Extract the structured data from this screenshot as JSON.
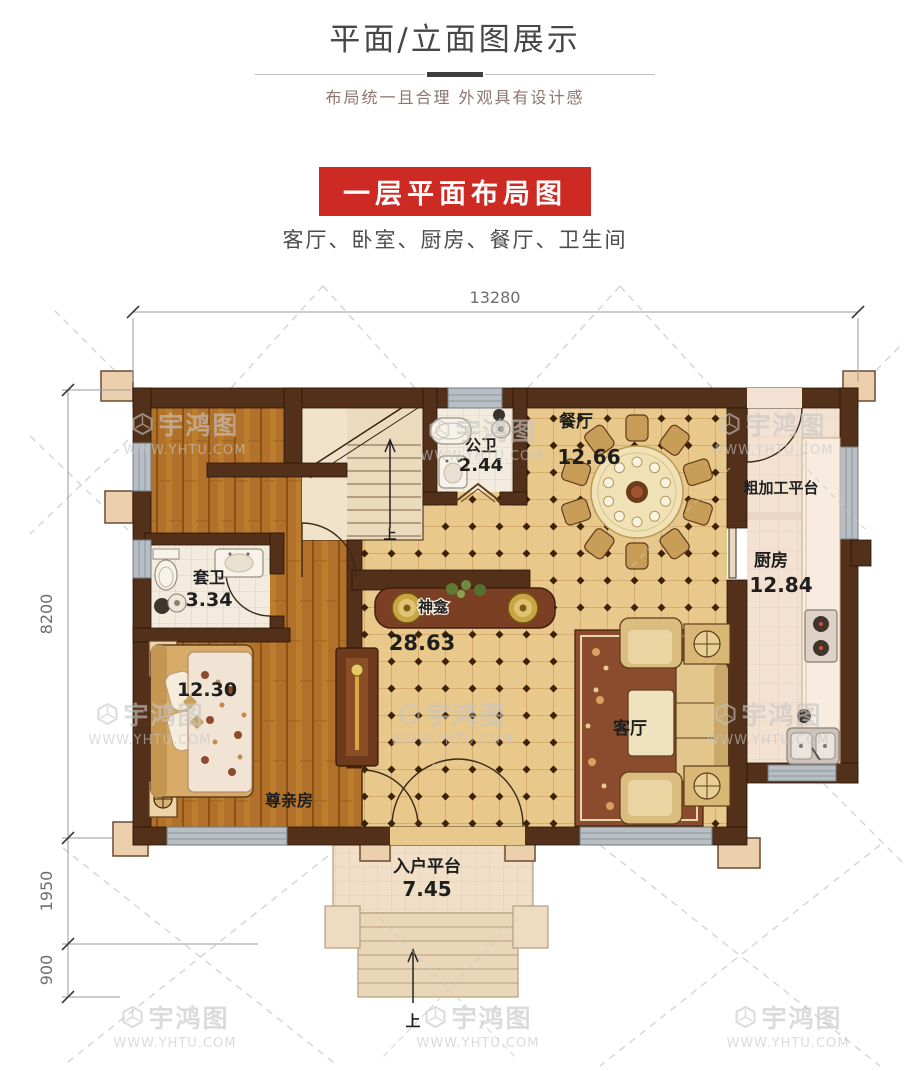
{
  "header": {
    "title": "平面/立面图展示",
    "subtitle": "布局统一且合理  外观具有设计感",
    "banner": "一层平面布局图",
    "rooms_line": "客厅、卧室、厨房、餐厅、卫生间",
    "banner_color": "#ce2a24"
  },
  "plan": {
    "dim_top": "13280",
    "dim_left_main": "8200",
    "dim_left_mid": "1950",
    "dim_left_low": "900",
    "labels": {
      "dining": {
        "name": "餐厅",
        "area": "12.66"
      },
      "public_bath": {
        "name": "公卫",
        "area": "2.44"
      },
      "rough_platform": {
        "name": "粗加工平台"
      },
      "kitchen": {
        "name": "厨房",
        "area": "12.84"
      },
      "ensuite_bath": {
        "name": "套卫",
        "area": "3.34"
      },
      "shrine": {
        "name": "神龛",
        "area": "28.63"
      },
      "living": {
        "name": "客厅"
      },
      "elder_room": {
        "name": "尊亲房",
        "area": "12.30"
      },
      "entry": {
        "name": "入户平台",
        "area": "7.45"
      },
      "stair_up": "上",
      "entry_up": "上"
    }
  },
  "watermark": {
    "logo": "宇鸿图",
    "url": "WWW.YHTU.COM"
  },
  "colors": {
    "wall": "#523019",
    "tile": "#e9c88c",
    "wood": "#b1712b",
    "kitchen_floor": "#f3e2d2",
    "window": "#b7bec4",
    "column": "#eccfad"
  }
}
